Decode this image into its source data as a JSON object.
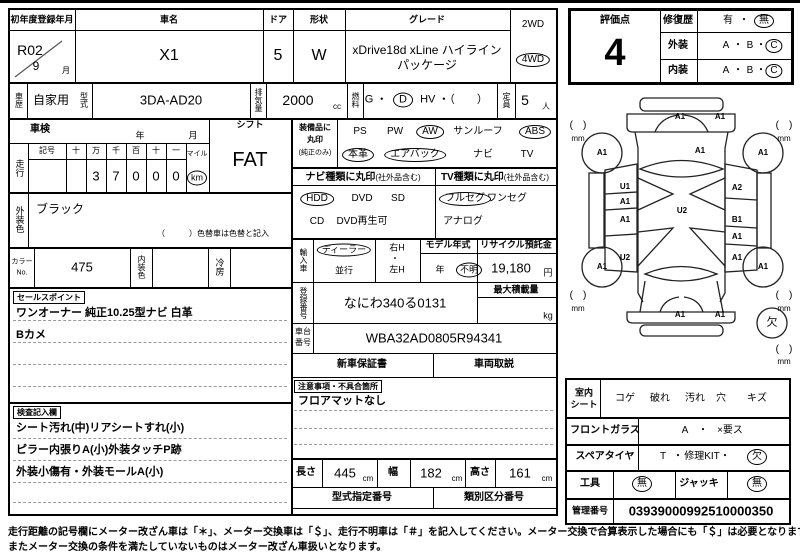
{
  "title_row": {
    "reg_label": "初年度登録年月",
    "reg_year": "R02",
    "reg_month": "9",
    "month": "月",
    "name_label": "車名",
    "name": "X1",
    "door_label": "ドア",
    "door": "5",
    "shape_label": "形状",
    "shape": "W",
    "grade_label": "グレード",
    "grade1": "xDrive18d xLine ハイライン",
    "grade2": "パッケージ",
    "wd2": "2WD",
    "wd4": "4WD"
  },
  "spec_row": {
    "history_label": "車歴",
    "history": "自家用",
    "model_label": "型式",
    "model": "3DA-AD20",
    "disp_label": "排気量",
    "disp": "2000",
    "disp_unit": "cc",
    "fuel_label": "燃料",
    "fuel_g": "G ・",
    "fuel_d": "D",
    "fuel_rest": "HV ・（　　）",
    "cap_label": "定員",
    "cap": "5",
    "cap_unit": "人"
  },
  "shaken": {
    "label": "車検",
    "year": "年",
    "month": "月"
  },
  "mileage": {
    "label": "走行",
    "h_kigo": "記号",
    "h_ju1": "十",
    "h_man": "万",
    "h_sen": "千",
    "h_hyaku": "百",
    "h_ju2": "十",
    "h_ichi": "一",
    "d_man": "3",
    "d_sen": "7",
    "d_hyaku": "0",
    "d_ju": "0",
    "d_ichi": "0",
    "mile": "マイル",
    "km": "km"
  },
  "shift": {
    "label": "シフト",
    "value": "FAT"
  },
  "ext_color": {
    "label": "外装色",
    "value": "ブラック",
    "note": "（　　　）色替車は色替と記入"
  },
  "color_row": {
    "no_label1": "カラー",
    "no_label2": "No.",
    "no": "475",
    "int_label": "内装色",
    "ac_label": "冷房"
  },
  "sales": {
    "tag": "セールスポイント",
    "line1": "ワンオーナー 純正10.25型ナビ 白革",
    "line2": "Bカメ"
  },
  "notes": {
    "tag": "検査記入欄",
    "line1": "シート汚れ(中)リアシートすれ(小)",
    "line2": "ピラー内張りA(小)外装タッチP跡",
    "line3": "外装小傷有・外装モールA(小)"
  },
  "equip": {
    "label1": "装備品に",
    "label2": "丸印",
    "label3": "(純正のみ)",
    "ps": "PS",
    "pw": "PW",
    "aw": "AW",
    "sunroof": "サンルーフ",
    "abs": "ABS",
    "leather": "本革",
    "airbag": "エアバック",
    "navi": "ナビ",
    "tv": "TV"
  },
  "navi_type": {
    "header": "ナビ種類に丸印",
    "header_sub": "(社外品含む)",
    "hdd": "HDD",
    "dvd": "DVD",
    "sd": "SD",
    "cd": "CD",
    "dvd_play": "DVD再生可"
  },
  "tv_type": {
    "header": "TV種類に丸印",
    "header_sub": "(社外品含む)",
    "full": "フルセグ",
    "one": "ワンセグ",
    "analog": "アナログ"
  },
  "import_row": {
    "label": "輸入車",
    "dealer": "ディーラー",
    "parallel": "並行",
    "rh": "右H",
    "dot": "・",
    "lh": "左H",
    "model_year_label": "モデル年式",
    "year": "年",
    "unknown": "不明",
    "recycle_label": "リサイクル預託金",
    "recycle": "19,180",
    "yen": "円"
  },
  "reg_no": {
    "label": "登録番号",
    "value": "なにわ340る0131",
    "max_load_label": "最大積載量",
    "kg": "kg"
  },
  "chassis": {
    "label1": "車台",
    "label2": "番号",
    "value": "WBA32AD0805R94341"
  },
  "docs": {
    "warranty": "新車保証書",
    "manual": "車両取説"
  },
  "caution": {
    "tag": "注意事項・不具合箇所",
    "line1": "フロアマットなし"
  },
  "dims": {
    "len_label": "長さ",
    "len": "445",
    "cm1": "cm",
    "wid_label": "幅",
    "wid": "182",
    "cm2": "cm",
    "hei_label": "高さ",
    "hei": "161",
    "cm3": "cm"
  },
  "type_no": {
    "model_no_label": "型式指定番号",
    "class_no_label": "類別区分番号"
  },
  "eval": {
    "score_label": "評価点",
    "score": "4",
    "repair_label": "修復歴",
    "repair_yes": "有",
    "dot": "・",
    "repair_no": "無",
    "ext_label": "外装",
    "int_label": "内装",
    "a": "A",
    "b": "B",
    "c": "C"
  },
  "diagram": {
    "labels": [
      "A1",
      "A1",
      "A1",
      "A1",
      "A1",
      "U1",
      "A2",
      "A1",
      "U2",
      "A1",
      "B1",
      "A1",
      "U2",
      "A1",
      "A1",
      "A1",
      "A1",
      "A1"
    ],
    "bracket": "(　)",
    "mm": "mm",
    "missing": "欠"
  },
  "interior": {
    "seat_label1": "室内",
    "seat_label2": "シート",
    "koge": "コゲ",
    "yabure": "破れ",
    "yogore": "汚れ",
    "ana": "穴",
    "kizu": "キズ",
    "glass_label": "フロントガラス",
    "glass_a": "A",
    "dot": "・",
    "glass_x": "×要ス",
    "spare_label": "スペアタイヤ",
    "spare_t": "T",
    "spare_kit": "修理KIT",
    "spare_ketsu": "欠",
    "tool_label": "工具",
    "tool_none": "無",
    "jack_label": "ジャッキ",
    "jack_none": "無",
    "mgmt_label": "管理番号",
    "mgmt_no": "03939000992510000350"
  },
  "footer": {
    "line1": "走行距離の記号欄にメーター改ざん車は「＊」、メーター交換車は「＄」、走行不明車は「＃」を記入してください。メーター交換で合算表示した場合にも「＄」は必要となります。",
    "line2": "またメーター交換の条件を満たしていないものはメーター改ざん車扱いとなります。"
  }
}
